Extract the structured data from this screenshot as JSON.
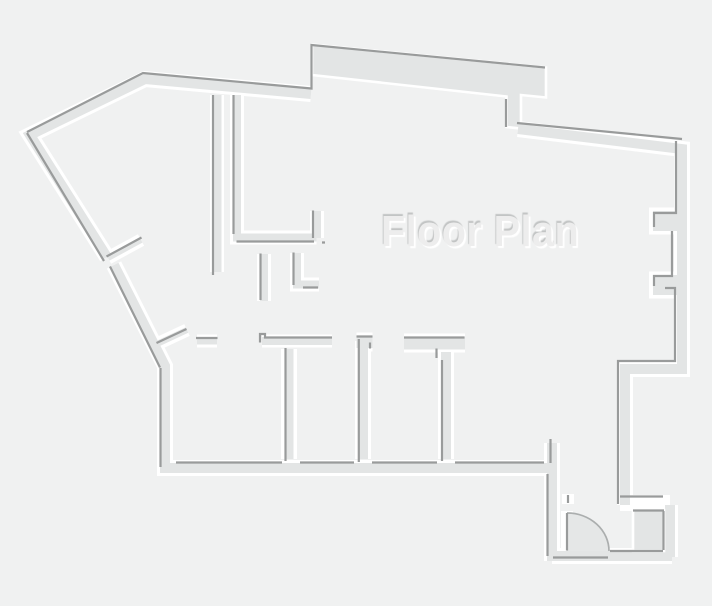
{
  "title": {
    "text": "Floor Plan"
  },
  "canvas": {
    "width": 712,
    "height": 606
  },
  "colors": {
    "background": "#f0f1f1",
    "wall_fill": "#e3e5e5",
    "wall_shadow_line": "#999b9b",
    "wall_highlight": "#ffffff",
    "door_arc_fill": "#e5e7e7",
    "door_arc_line": "#abaeae",
    "title_fill": "#ededed",
    "title_shadow": "#c2c4c4",
    "title_highlight": "#ffffff"
  }
}
